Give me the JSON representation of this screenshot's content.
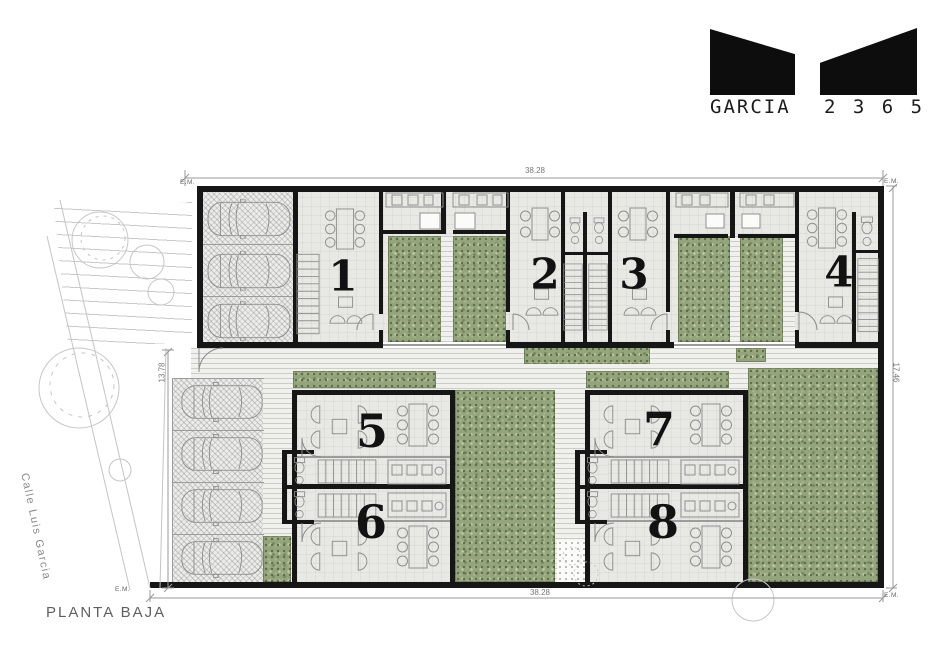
{
  "logo": {
    "name": "GARCIA",
    "numbers": "2 3 6 5"
  },
  "plan": {
    "title": "PLANTA BAJA",
    "street_label": "Calle Luis Garcia",
    "units": [
      {
        "label": "1"
      },
      {
        "label": "2"
      },
      {
        "label": "3"
      },
      {
        "label": "4"
      },
      {
        "label": "5"
      },
      {
        "label": "6"
      },
      {
        "label": "7"
      },
      {
        "label": "8"
      }
    ],
    "dimensions": {
      "top": "38.28",
      "bottom": "38.28",
      "right": "17.46",
      "left": "13.78",
      "em": "E.M."
    }
  },
  "colors": {
    "wall": "#161616",
    "green": "#94a47c",
    "floor": "#e8e8e5",
    "dim_text": "#777777"
  }
}
